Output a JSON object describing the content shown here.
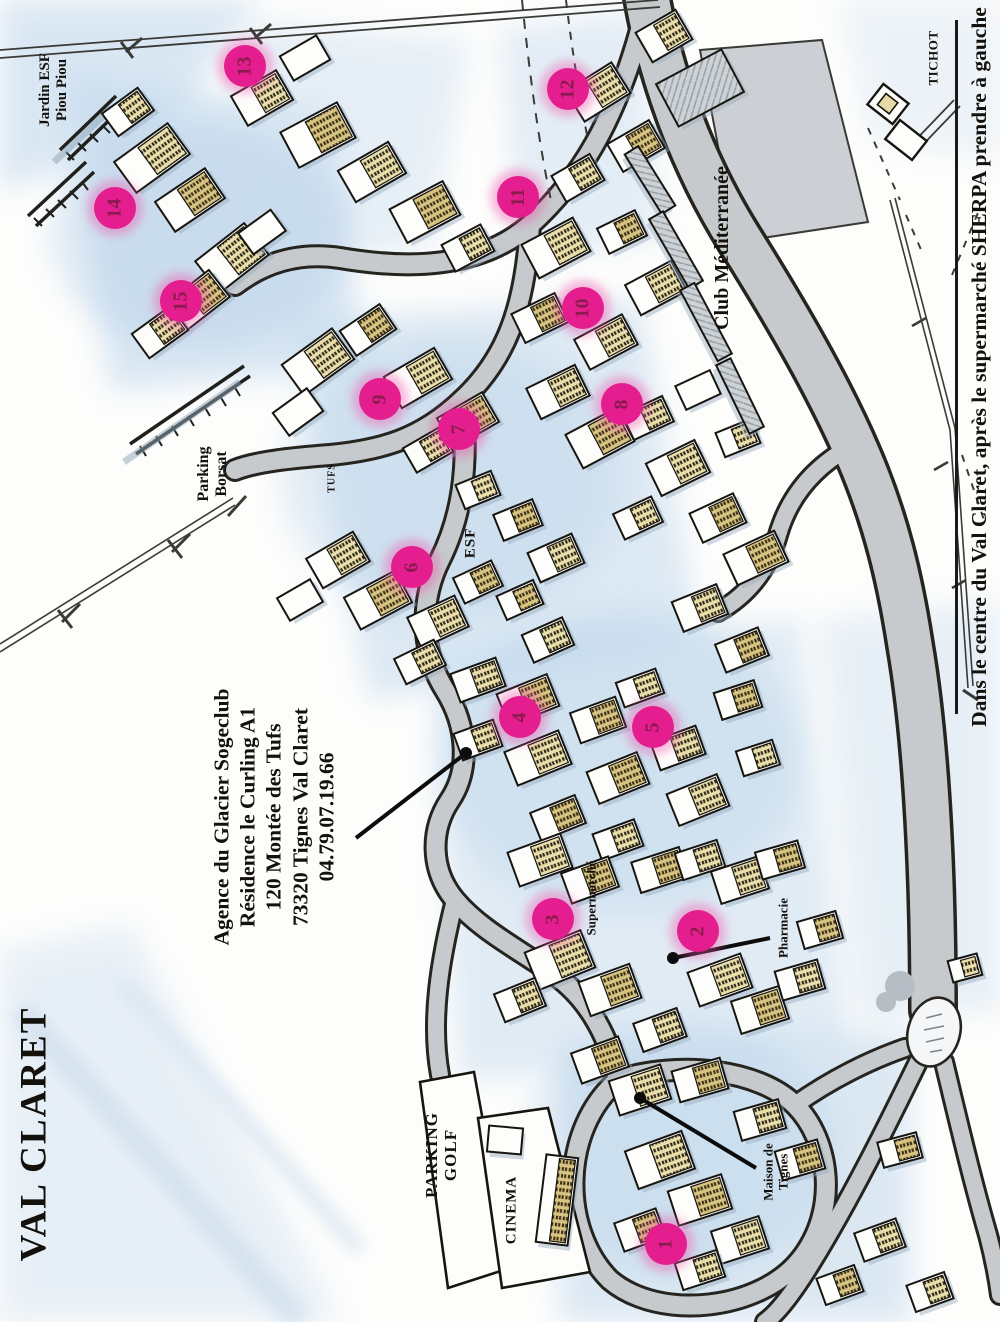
{
  "title": "VAL CLARET",
  "note": {
    "text": "Dans le centre du Val Claret, après le supermarché SHERPA prendre à gauche"
  },
  "agency": {
    "lines": [
      "Agence du Glacier Sogeclub",
      "Résidence le Curling A1",
      "120 Montée des Tufs",
      "73320 Tignes Val Claret",
      "04.79.07.19.66"
    ]
  },
  "labels": {
    "jardin": [
      "Jardin ESF",
      "Piou Piou"
    ],
    "tichot": "TICHOT",
    "club_med": "Club Méditerranée",
    "parking_borsat": [
      "Parking",
      "Borsat"
    ],
    "tufs": "TUFS",
    "esf": "ESF",
    "supermarche": "Supermarché",
    "pharmacie": "Pharmacie",
    "maison_de_tignes": [
      "Maison de",
      "Tignes"
    ],
    "parking_golf": [
      "PARKING",
      "GOLF"
    ],
    "cinema": "CINEMA"
  },
  "markers": {
    "numbers": [
      "1",
      "2",
      "3",
      "4",
      "5",
      "6",
      "7",
      "8",
      "9",
      "10",
      "11",
      "12",
      "13",
      "14",
      "15"
    ]
  },
  "colors": {
    "marker_fill": "#e41e8e",
    "marker_number": "#8d1a4e",
    "road_gray": "#c6cacd",
    "wash_blue": "#ccdff0"
  }
}
